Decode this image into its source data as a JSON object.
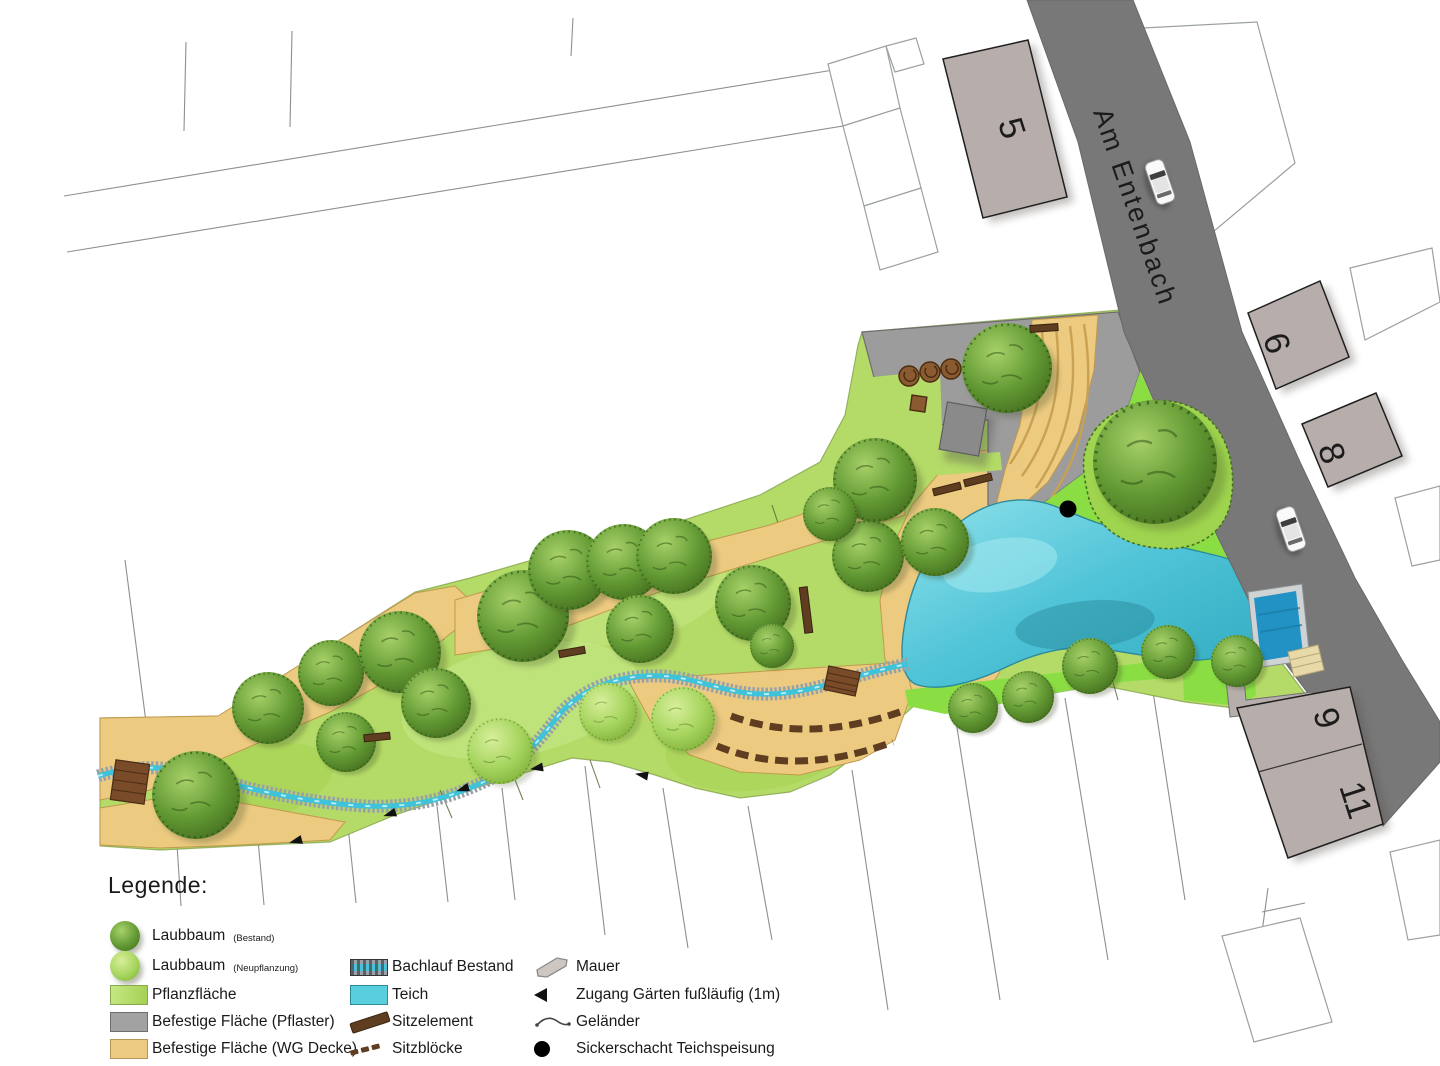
{
  "plan": {
    "street_label": "Am Entenbach",
    "buildings": {
      "b5": "5",
      "b6": "6",
      "b8": "8",
      "b9": "9",
      "b11": "11"
    }
  },
  "legend": {
    "title": "Legende:",
    "col1": [
      {
        "label": "Laubbaum",
        "note": "(Bestand)"
      },
      {
        "label": "Laubbaum",
        "note": "(Neupflanzung)"
      },
      {
        "label": "Pflanzfläche",
        "note": ""
      },
      {
        "label": "Befestige Fläche (Pflaster)",
        "note": ""
      },
      {
        "label": "Befestige Fläche (WG Decke)",
        "note": ""
      }
    ],
    "col2": [
      {
        "label": "Bachlauf Bestand"
      },
      {
        "label": "Teich"
      },
      {
        "label": "Sitzelement"
      },
      {
        "label": "Sitzblöcke"
      }
    ],
    "col3": [
      {
        "label": "Mauer"
      },
      {
        "label": "Zugang Gärten fußläufig (1m)"
      },
      {
        "label": "Geländer"
      },
      {
        "label": "Sickerschacht Teichspeisung"
      }
    ]
  },
  "colors": {
    "road": "#787878",
    "building": "#b7aeac",
    "planting_area": "#b4db67",
    "lawn_new": "#8ade44",
    "paved_pflaster": "#9c9c9c",
    "paved_wg_decke": "#ecca80",
    "pond": "#56c9db",
    "pool": "#2292c4",
    "stream_water": "#3ec3da",
    "wood_brown": "#5f3d20",
    "tree_dark": "#5f9431",
    "tree_light": "#a6d55f"
  }
}
